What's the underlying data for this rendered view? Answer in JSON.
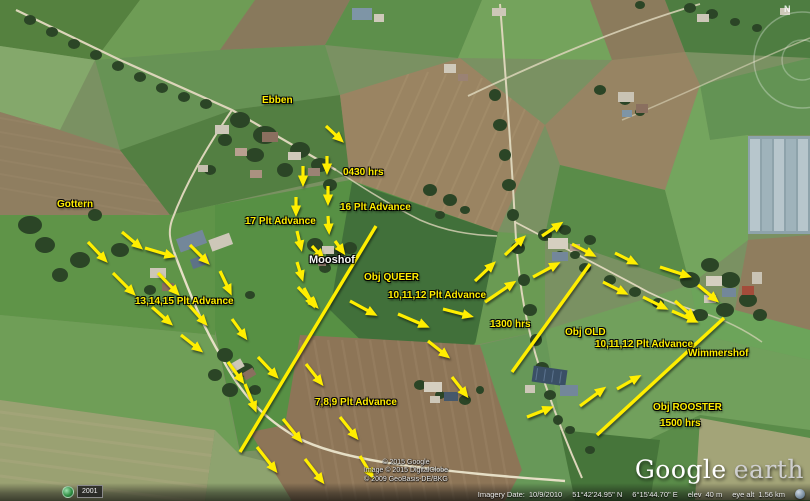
{
  "app": {
    "name": "Google Earth"
  },
  "annotations": {
    "labels": [
      {
        "name": "label-ebben",
        "text": "Ebben",
        "x": 262,
        "y": 95,
        "style": "yellow"
      },
      {
        "name": "label-gottern",
        "text": "Gottern",
        "x": 57,
        "y": 199,
        "style": "yellow"
      },
      {
        "name": "label-0430-hrs",
        "text": "0430 hrs",
        "x": 343,
        "y": 167,
        "style": "yellow"
      },
      {
        "name": "label-17-plt-advance",
        "text": "17 Plt Advance",
        "x": 245,
        "y": 216,
        "style": "yellow"
      },
      {
        "name": "label-16-plt-advance",
        "text": "16 Plt Advance",
        "x": 340,
        "y": 202,
        "style": "yellow"
      },
      {
        "name": "label-mooshof",
        "text": "Mooshof",
        "x": 309,
        "y": 254,
        "style": "white"
      },
      {
        "name": "label-obj-queer",
        "text": "Obj QUEER",
        "x": 364,
        "y": 272,
        "style": "yellow"
      },
      {
        "name": "label-13-14-15-plt-advance",
        "text": "13,14,15 Plt Advance",
        "x": 135,
        "y": 296,
        "style": "yellow"
      },
      {
        "name": "label-10-11-12-plt-advance-1",
        "text": "10,11,12 Plt Advance",
        "x": 388,
        "y": 290,
        "style": "yellow"
      },
      {
        "name": "label-1300-hrs",
        "text": "1300 hrs",
        "x": 490,
        "y": 319,
        "style": "yellow"
      },
      {
        "name": "label-obj-old",
        "text": "Obj OLD",
        "x": 565,
        "y": 327,
        "style": "yellow"
      },
      {
        "name": "label-10-11-12-plt-advance-2",
        "text": "10,11,12 Plt Advance",
        "x": 595,
        "y": 339,
        "style": "yellow"
      },
      {
        "name": "label-wimmershof",
        "text": "Wimmershof",
        "x": 688,
        "y": 348,
        "style": "yellow"
      },
      {
        "name": "label-7-8-9-plt-advance",
        "text": "7,8,9 Plt Advance",
        "x": 315,
        "y": 397,
        "style": "yellow"
      },
      {
        "name": "label-obj-rooster",
        "text": "Obj ROOSTER",
        "x": 653,
        "y": 402,
        "style": "yellow"
      },
      {
        "name": "label-1500-hrs",
        "text": "1500 hrs",
        "x": 660,
        "y": 418,
        "style": "yellow"
      }
    ],
    "objective_lines": [
      {
        "name": "obj-queer-line",
        "points": [
          376,
          226,
          240,
          452
        ]
      },
      {
        "name": "obj-old-line",
        "points": [
          590,
          264,
          512,
          372
        ]
      },
      {
        "name": "obj-rooster-line",
        "points": [
          724,
          318,
          597,
          435
        ]
      }
    ],
    "arrows": [
      [
        326,
        126,
        341,
        140
      ],
      [
        327,
        156,
        327,
        171
      ],
      [
        303,
        166,
        303,
        183
      ],
      [
        296,
        197,
        296,
        213
      ],
      [
        328,
        186,
        328,
        202
      ],
      [
        328,
        216,
        329,
        231
      ],
      [
        297,
        231,
        301,
        248
      ],
      [
        312,
        246,
        322,
        257
      ],
      [
        335,
        241,
        343,
        252
      ],
      [
        297,
        262,
        302,
        278
      ],
      [
        304,
        288,
        313,
        305
      ],
      [
        88,
        242,
        105,
        260
      ],
      [
        122,
        232,
        140,
        247
      ],
      [
        145,
        248,
        172,
        256
      ],
      [
        190,
        245,
        207,
        262
      ],
      [
        113,
        273,
        133,
        293
      ],
      [
        158,
        273,
        177,
        293
      ],
      [
        220,
        271,
        230,
        292
      ],
      [
        152,
        307,
        170,
        323
      ],
      [
        188,
        304,
        205,
        323
      ],
      [
        232,
        319,
        245,
        337
      ],
      [
        181,
        335,
        200,
        350
      ],
      [
        228,
        362,
        242,
        381
      ],
      [
        245,
        384,
        255,
        409
      ],
      [
        258,
        357,
        276,
        376
      ],
      [
        298,
        287,
        316,
        306
      ],
      [
        306,
        364,
        321,
        383
      ],
      [
        283,
        419,
        300,
        440
      ],
      [
        257,
        447,
        275,
        470
      ],
      [
        305,
        459,
        322,
        481
      ],
      [
        340,
        417,
        356,
        437
      ],
      [
        360,
        456,
        372,
        476
      ],
      [
        350,
        301,
        374,
        314
      ],
      [
        398,
        314,
        426,
        326
      ],
      [
        443,
        309,
        470,
        316
      ],
      [
        428,
        341,
        447,
        356
      ],
      [
        452,
        377,
        466,
        395
      ],
      [
        485,
        302,
        513,
        283
      ],
      [
        475,
        281,
        493,
        264
      ],
      [
        505,
        255,
        523,
        238
      ],
      [
        533,
        277,
        557,
        264
      ],
      [
        542,
        236,
        560,
        224
      ],
      [
        572,
        244,
        593,
        255
      ],
      [
        615,
        253,
        635,
        263
      ],
      [
        603,
        282,
        625,
        293
      ],
      [
        660,
        267,
        688,
        276
      ],
      [
        643,
        297,
        665,
        308
      ],
      [
        672,
        311,
        695,
        321
      ],
      [
        698,
        285,
        716,
        300
      ],
      [
        675,
        301,
        693,
        317
      ],
      [
        527,
        417,
        550,
        408
      ],
      [
        580,
        406,
        603,
        389
      ],
      [
        617,
        389,
        638,
        377
      ]
    ],
    "accent_color": "#ffee00"
  },
  "overlay": {
    "copyright": [
      "© 2015 Google",
      "Image © 2015 DigitalGlobe",
      "© 2009 GeoBasis-DE/BKG"
    ],
    "logo": {
      "google": "Google",
      "earth": "earth"
    },
    "status_bar": {
      "imagery_date_label": "Imagery Date:",
      "imagery_date": "10/9/2010",
      "latitude": "51°42'24.95\" N",
      "longitude": "6°15'44.70\" E",
      "elev_label": "elev",
      "elev_value": "40 m",
      "eye_alt_label": "eye alt",
      "eye_alt_value": "1.56 km"
    },
    "time_marker": {
      "year": "2001"
    },
    "compass": {
      "north_label": "N"
    }
  }
}
